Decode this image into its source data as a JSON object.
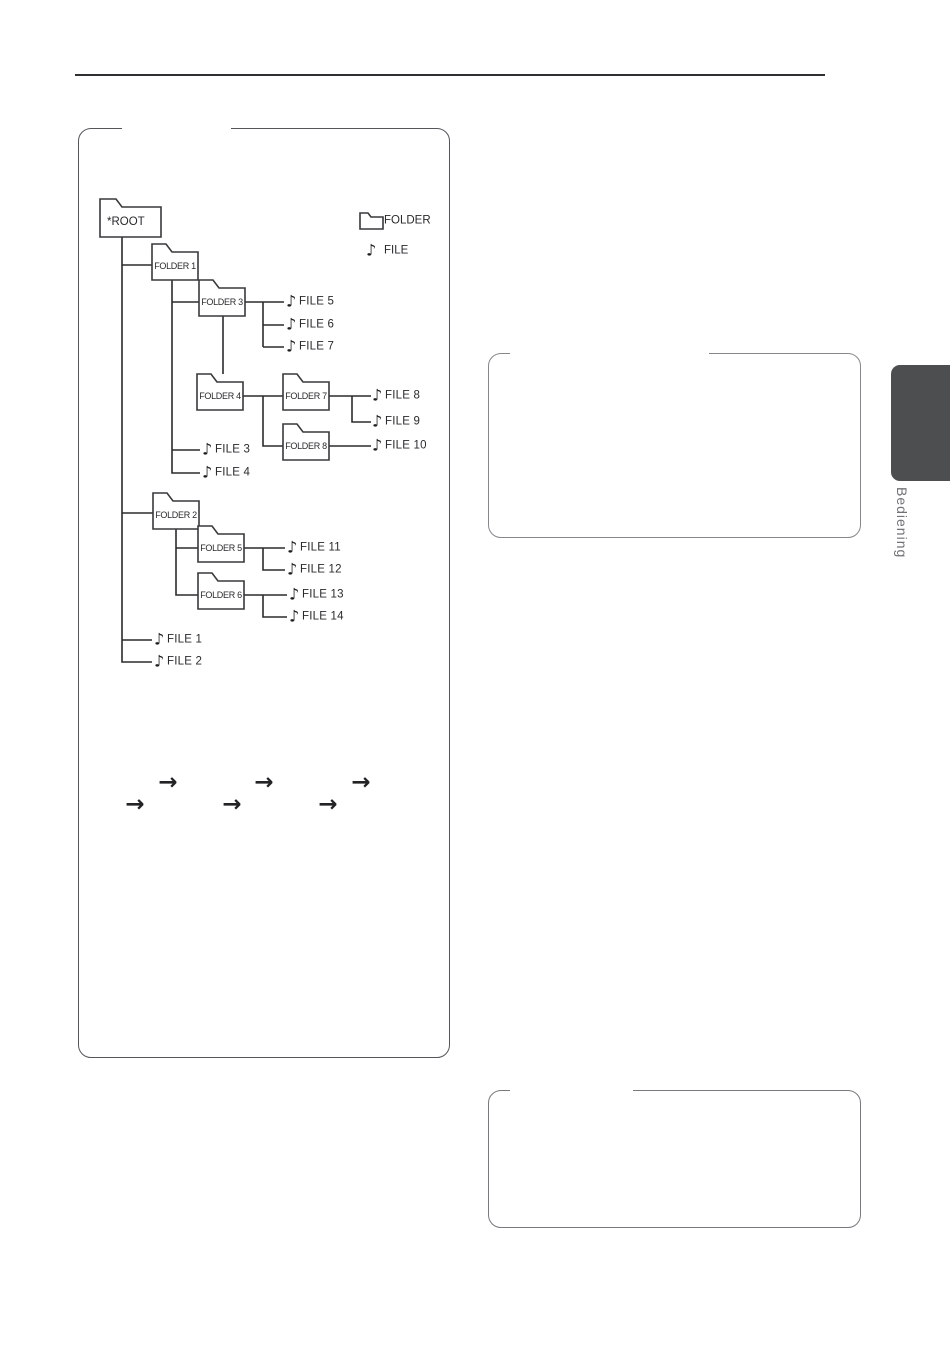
{
  "page": {
    "sidebar_label": "Bediening"
  },
  "legend": {
    "folder": "FOLDER",
    "file": "FILE"
  },
  "icons": {
    "note": "♪",
    "arrow": "→"
  },
  "tree": {
    "root": "*ROOT",
    "folders": [
      "FOLDER 1",
      "FOLDER 3",
      "FOLDER 4",
      "FOLDER 7",
      "FOLDER 8",
      "FOLDER 2",
      "FOLDER 5",
      "FOLDER 6"
    ],
    "files": [
      "FILE 1",
      "FILE 2",
      "FILE 3",
      "FILE 4",
      "FILE 5",
      "FILE 6",
      "FILE 7",
      "FILE 8",
      "FILE 9",
      "FILE 10",
      "FILE 11",
      "FILE 12",
      "FILE 13",
      "FILE 14"
    ]
  },
  "colors": {
    "line": "#2b2b2d",
    "folder_stroke": "#39393b",
    "diagram_box_border": "#55565a",
    "callout_border": "#85878a",
    "tab_bg": "#4d4e50",
    "tab_text": "#717276"
  }
}
